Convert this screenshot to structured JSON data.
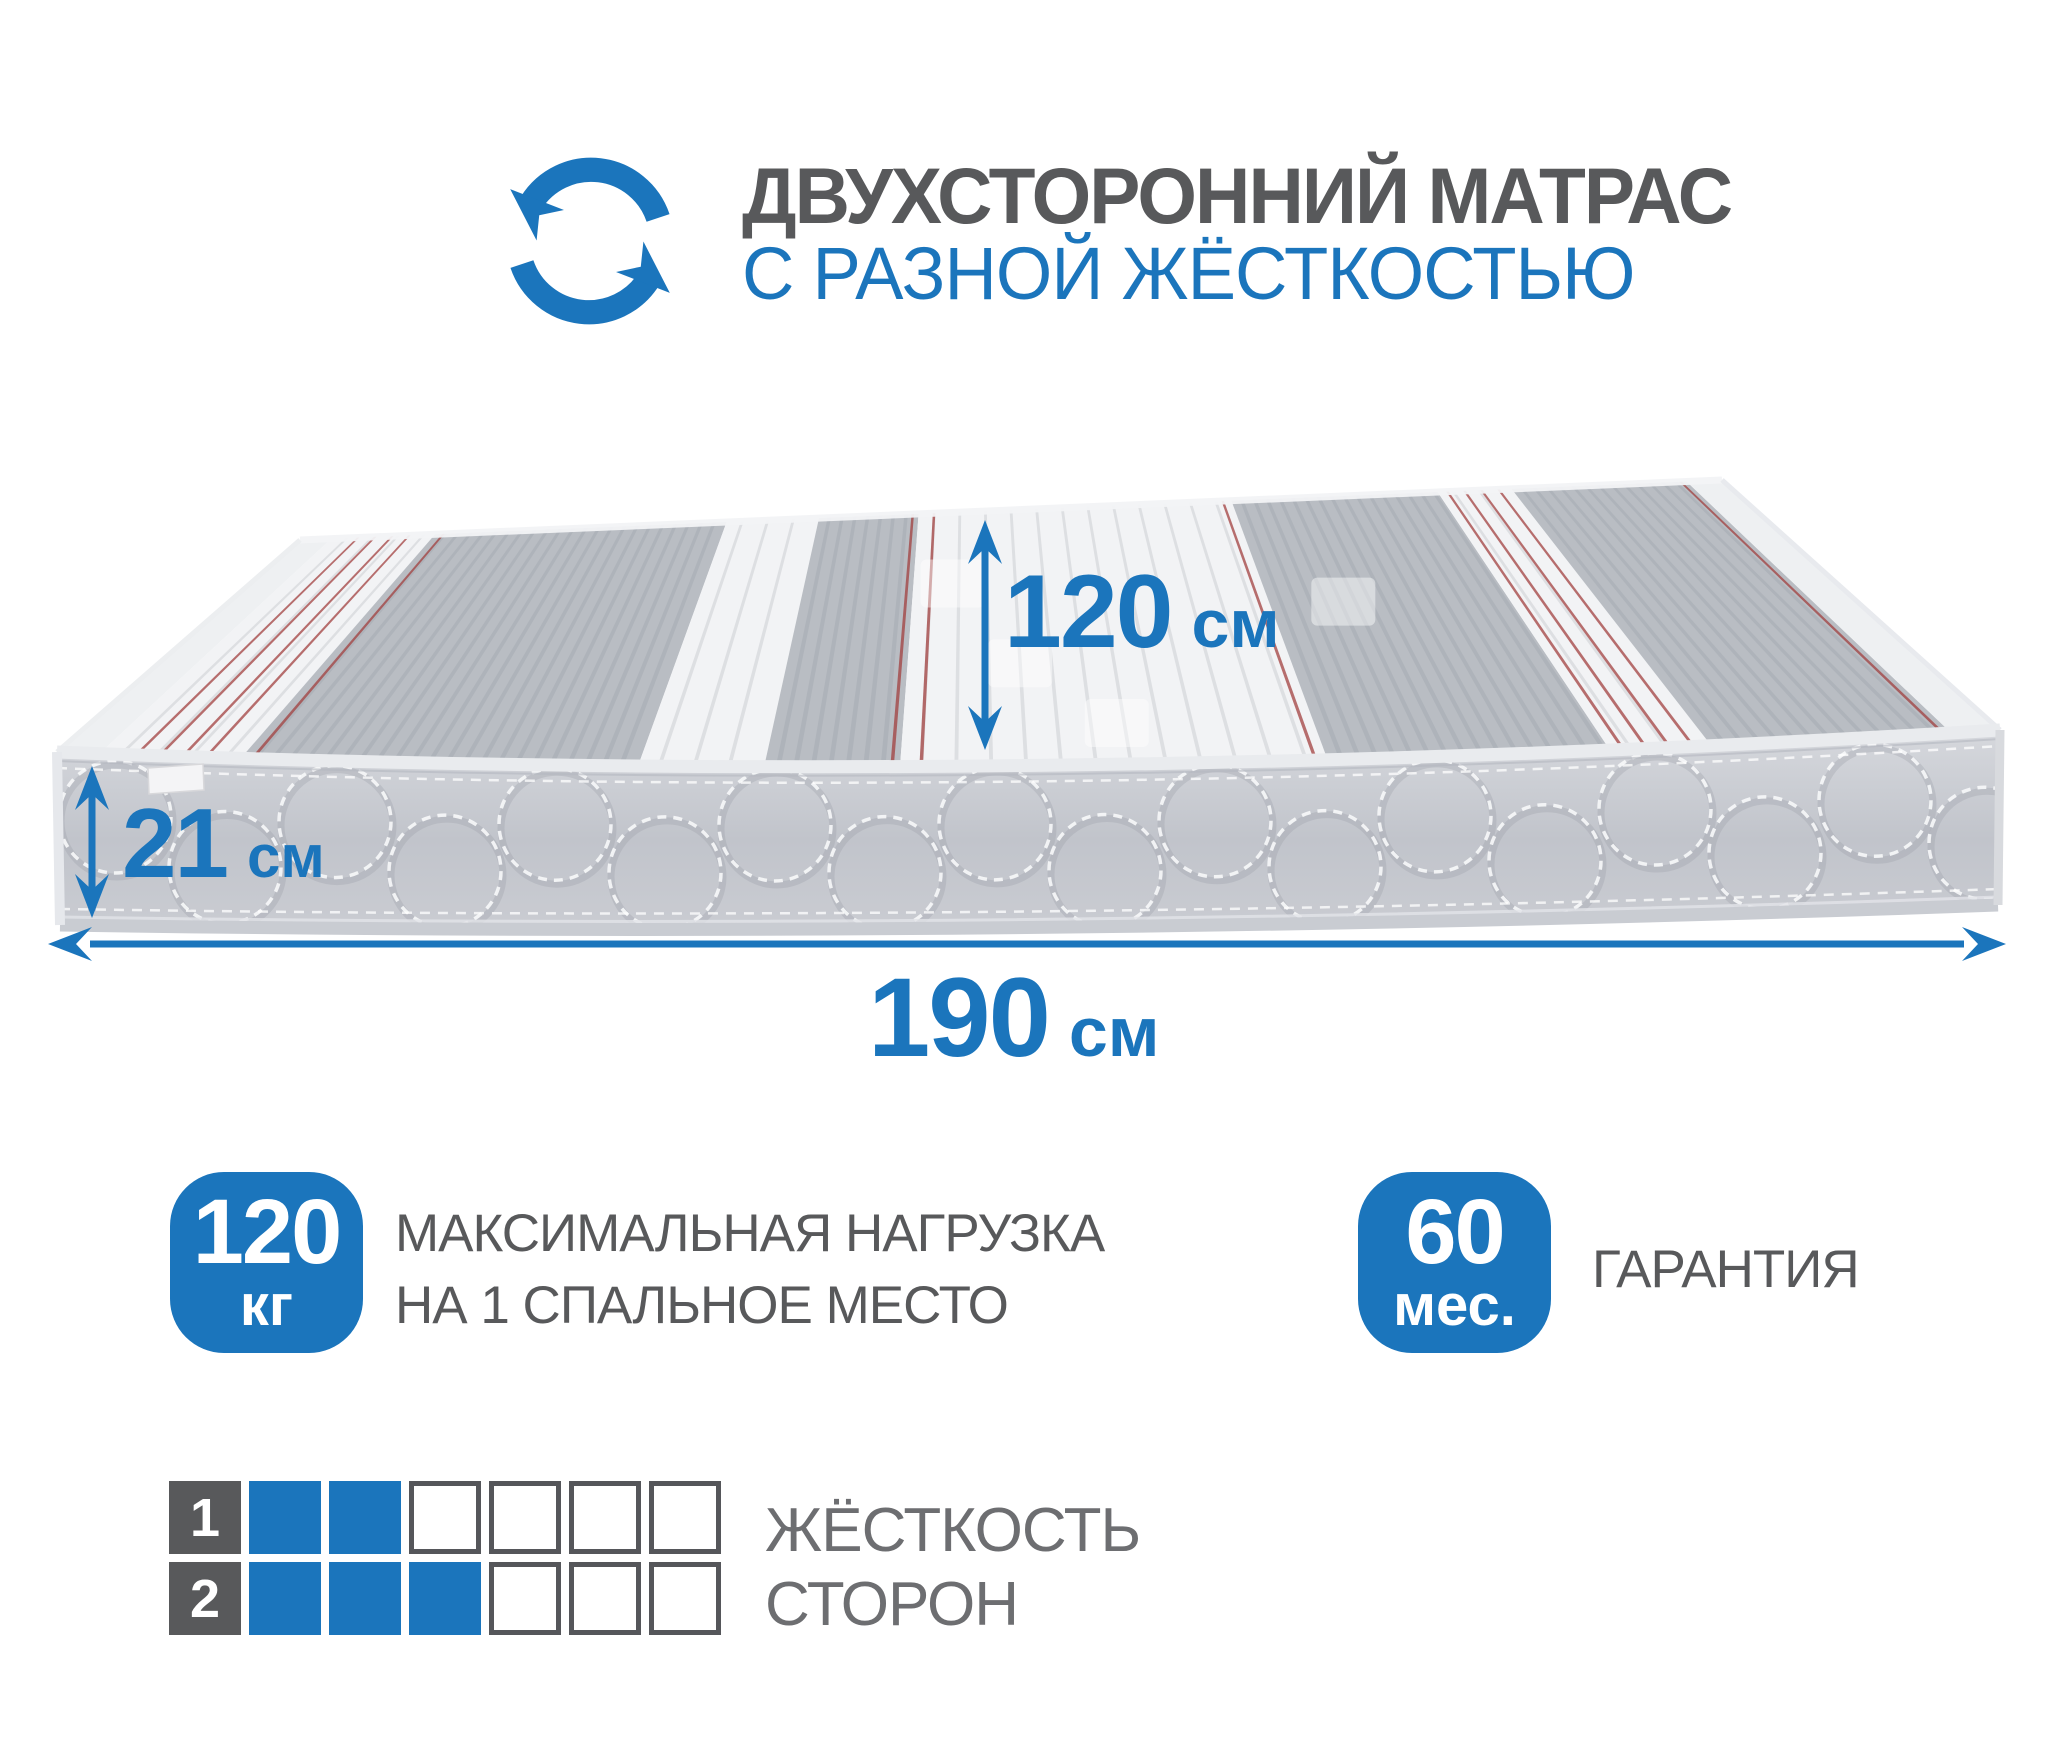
{
  "colors": {
    "accent": "#1b75bc",
    "title_gray": "#58595b",
    "caption_gray": "#6d6e71",
    "red_pinstripe": "#a2403f",
    "side_light": "#d6d8dd",
    "side_dark": "#c1c4cb",
    "band_gray": "#b9bdc3",
    "band_white": "#f2f3f5"
  },
  "header": {
    "icon": "rotate-arrows-icon",
    "title": "ДВУХСТОРОННИЙ МАТРАС",
    "subtitle": "С РАЗНОЙ ЖЁСТКОСТЬЮ"
  },
  "mattress": {
    "illustration": "two-sided-mattress-3d-view",
    "dimensions": {
      "width": {
        "value": "120",
        "unit": "см"
      },
      "thickness": {
        "value": "21",
        "unit": "см"
      },
      "length": {
        "value": "190",
        "unit": "см"
      }
    }
  },
  "specs": [
    {
      "badge_value": "120",
      "badge_unit": "кг",
      "caption_lines": [
        "МАКСИМАЛЬНАЯ НАГРУЗКА",
        "НА 1 СПАЛЬНОЕ МЕСТО"
      ]
    },
    {
      "badge_value": "60",
      "badge_unit": "мес.",
      "caption_lines": [
        "ГАРАНТИЯ"
      ]
    }
  ],
  "firmness": {
    "caption_lines": [
      "ЖЁСТКОСТЬ",
      "СТОРОН"
    ],
    "scale_cells": 6,
    "rows": [
      {
        "label": "1",
        "filled": 2
      },
      {
        "label": "2",
        "filled": 3
      }
    ]
  }
}
